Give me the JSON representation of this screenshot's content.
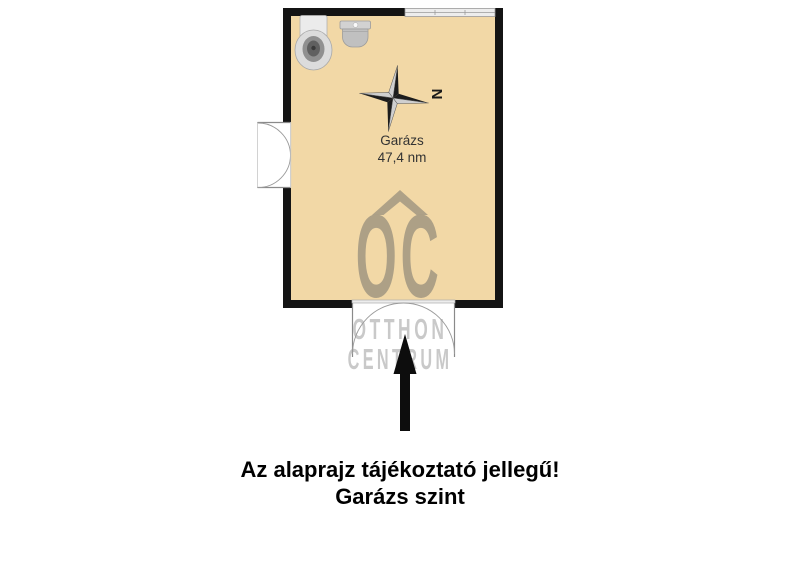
{
  "floorplan": {
    "room": {
      "name": "Garázs",
      "area": "47,4 nm"
    },
    "compass": {
      "north_label": "N",
      "icon": "compass-rose-icon"
    },
    "fixtures": {
      "toilet": "toilet-icon",
      "sink": "sink-icon"
    },
    "openings": {
      "left": "double-door",
      "bottom": "double-garage-door",
      "top": "window"
    },
    "colors": {
      "floor": "#F2D8A6",
      "wall": "#141414",
      "window_fill": "#EDEDED",
      "door_line": "#9A9A9A",
      "logo": "#A89C84",
      "watermark_text": "#C9C9C9",
      "arrow": "#0D0D0D"
    }
  },
  "watermark": {
    "logo_letters": "OC",
    "logo_icon": "roof-chevron-icon",
    "word1": "OTTHON",
    "word2": "CENTRUM"
  },
  "arrow": {
    "icon": "up-arrow-icon"
  },
  "caption": {
    "line1": "Az alaprajz tájékoztató jellegű!",
    "line2": "Garázs szint"
  }
}
